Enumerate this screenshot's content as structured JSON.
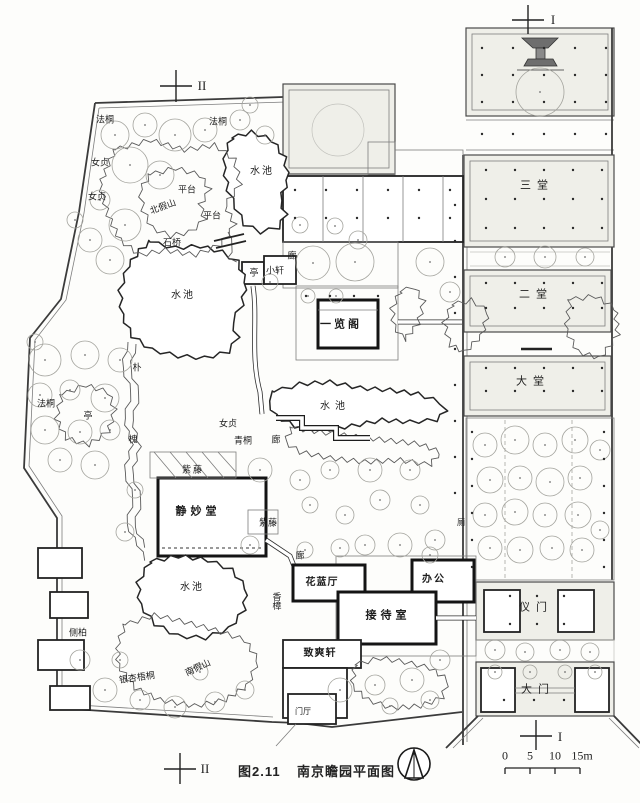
{
  "figure": {
    "caption_label": "图2.11",
    "caption_title": "南京瞻园平面图"
  },
  "section_markers": {
    "top_left": "II",
    "top_right": "I",
    "bottom_left": "II",
    "bottom_right": "I"
  },
  "scale_bar": {
    "ticks": [
      "0",
      "5",
      "10",
      "15m"
    ]
  },
  "icons": {
    "north_arrow": "north-arrow-icon",
    "stage_platform": "stage-platform-icon"
  },
  "labels": [
    {
      "text": "法桐",
      "x": 105,
      "y": 120,
      "size": 9
    },
    {
      "text": "法桐",
      "x": 218,
      "y": 122,
      "size": 9
    },
    {
      "text": "女贞",
      "x": 100,
      "y": 163,
      "size": 9
    },
    {
      "text": "女贞",
      "x": 97,
      "y": 197,
      "size": 9
    },
    {
      "text": "水池",
      "x": 262,
      "y": 172,
      "size": 10,
      "spacing": 2
    },
    {
      "text": "平台",
      "x": 187,
      "y": 190,
      "size": 9
    },
    {
      "text": "北假山",
      "x": 163,
      "y": 207,
      "size": 9,
      "rotate": -20
    },
    {
      "text": "平台",
      "x": 212,
      "y": 216,
      "size": 9
    },
    {
      "text": "石桥",
      "x": 172,
      "y": 243,
      "size": 9
    },
    {
      "text": "亭",
      "x": 254,
      "y": 273,
      "size": 9
    },
    {
      "text": "小轩",
      "x": 275,
      "y": 271,
      "size": 9
    },
    {
      "text": "廊",
      "x": 292,
      "y": 256,
      "size": 9
    },
    {
      "text": "水池",
      "x": 183,
      "y": 296,
      "size": 10,
      "spacing": 2
    },
    {
      "text": "一览阁",
      "x": 341,
      "y": 325,
      "size": 11,
      "bold": true,
      "spacing": 3
    },
    {
      "text": "朴",
      "x": 137,
      "y": 368,
      "size": 9
    },
    {
      "text": "法桐",
      "x": 46,
      "y": 404,
      "size": 9
    },
    {
      "text": "亭",
      "x": 88,
      "y": 416,
      "size": 9
    },
    {
      "text": "水池",
      "x": 335,
      "y": 407,
      "size": 10,
      "spacing": 5
    },
    {
      "text": "女贞",
      "x": 228,
      "y": 424,
      "size": 9
    },
    {
      "text": "青桐",
      "x": 243,
      "y": 441,
      "size": 9
    },
    {
      "text": "廊",
      "x": 276,
      "y": 440,
      "size": 9
    },
    {
      "text": "槐",
      "x": 133,
      "y": 440,
      "size": 9
    },
    {
      "text": "紫藤",
      "x": 193,
      "y": 470,
      "size": 9,
      "spacing": 2
    },
    {
      "text": "静妙堂",
      "x": 198,
      "y": 512,
      "size": 11,
      "bold": true,
      "spacing": 4
    },
    {
      "text": "紫藤",
      "x": 268,
      "y": 523,
      "size": 9
    },
    {
      "text": "厕",
      "x": 461,
      "y": 523,
      "size": 8
    },
    {
      "text": "香樟",
      "x": 276,
      "y": 601,
      "size": 9,
      "vertical": true
    },
    {
      "text": "廊",
      "x": 300,
      "y": 556,
      "size": 9
    },
    {
      "text": "花蓝厅",
      "x": 322,
      "y": 583,
      "size": 10,
      "bold": true,
      "spacing": 1
    },
    {
      "text": "办公",
      "x": 434,
      "y": 580,
      "size": 10,
      "bold": true,
      "spacing": 2
    },
    {
      "text": "接待室",
      "x": 388,
      "y": 616,
      "size": 11,
      "bold": true,
      "spacing": 4
    },
    {
      "text": "侧柏",
      "x": 78,
      "y": 633,
      "size": 9
    },
    {
      "text": "水池",
      "x": 192,
      "y": 588,
      "size": 10,
      "spacing": 2
    },
    {
      "text": "南假山",
      "x": 198,
      "y": 668,
      "size": 9,
      "rotate": -25
    },
    {
      "text": "银杏梧桐",
      "x": 137,
      "y": 678,
      "size": 9,
      "rotate": -8
    },
    {
      "text": "致爽轩",
      "x": 320,
      "y": 654,
      "size": 10,
      "bold": true,
      "spacing": 1
    },
    {
      "text": "门厅",
      "x": 303,
      "y": 712,
      "size": 8
    },
    {
      "text": "三堂",
      "x": 537,
      "y": 186,
      "size": 11,
      "spacing": 6
    },
    {
      "text": "二堂",
      "x": 536,
      "y": 295,
      "size": 11,
      "spacing": 6
    },
    {
      "text": "大堂",
      "x": 533,
      "y": 382,
      "size": 11,
      "spacing": 6
    },
    {
      "text": "仪门",
      "x": 536,
      "y": 608,
      "size": 11,
      "spacing": 6
    },
    {
      "text": "大门",
      "x": 538,
      "y": 690,
      "size": 11,
      "spacing": 6
    }
  ]
}
